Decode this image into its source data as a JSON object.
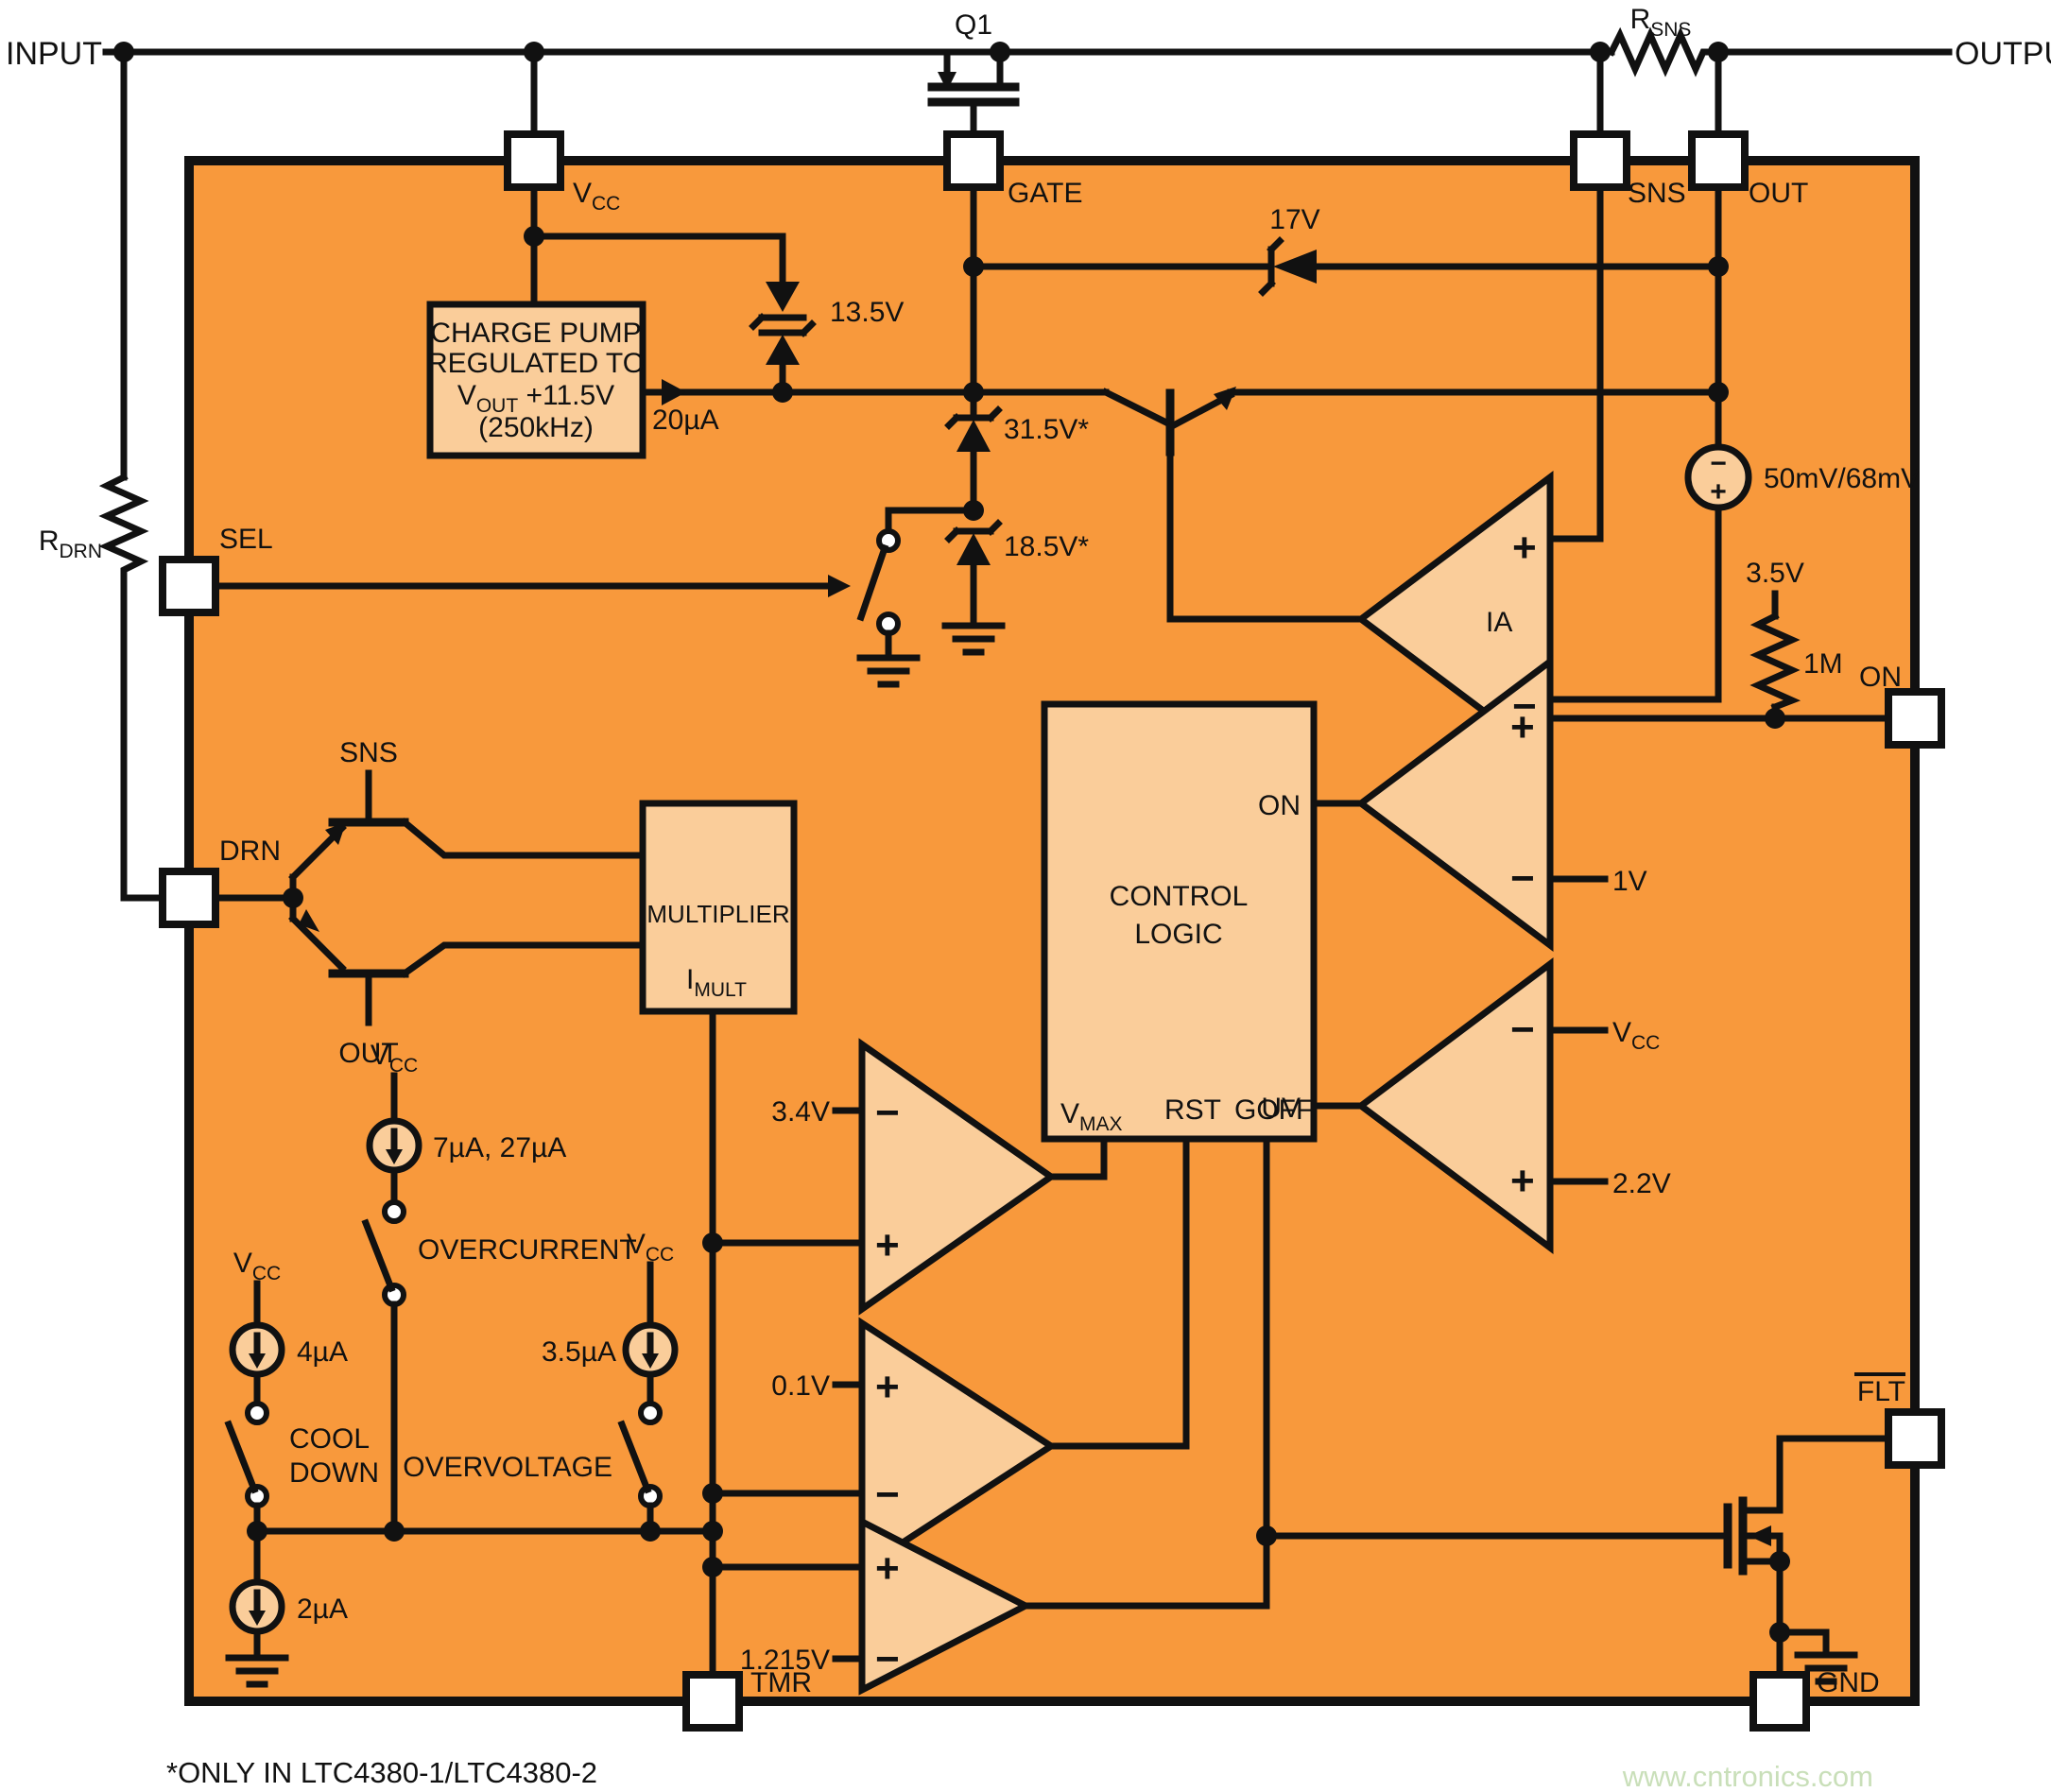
{
  "colors": {
    "ic_fill": "#f8993c",
    "block_fill": "#facd9a",
    "line": "#111111",
    "pin_fill": "#ffffff",
    "watermark": "#c9dfb9"
  },
  "symbols": {
    "plus": "+",
    "minus": "−"
  },
  "external": {
    "input": "INPUT",
    "output": "OUTPUT",
    "q1": "Q1",
    "rsns": {
      "base": "R",
      "sub": "SNS"
    },
    "rdrn": {
      "base": "R",
      "sub": "DRN"
    }
  },
  "pins": {
    "vcc": {
      "base": "V",
      "sub": "CC"
    },
    "gate": "GATE",
    "sns": "SNS",
    "out": "OUT",
    "sel": "SEL",
    "drn": "DRN",
    "on": "ON",
    "flt": "FLT",
    "tmr": "TMR",
    "gnd": "GND"
  },
  "charge_pump": {
    "line1": "CHARGE PUMP",
    "line2": "REGULATED TO",
    "line3_base": "V",
    "line3_sub": "OUT",
    "line3_rest": " +11.5V",
    "line4": "(250kHz)",
    "output_current": "20µA"
  },
  "zeners": {
    "z13v5": "13.5V",
    "z17v": "17V",
    "z31v5": "31.5V*",
    "z18v5": "18.5V*"
  },
  "ia": {
    "label": "IA",
    "offset_source": "50mV/68mV"
  },
  "on_comparator": {
    "pullup_voltage": "3.5V",
    "pullup_resistor": "1M",
    "minus_ref": "1V"
  },
  "uv_comparator": {
    "minus_ref": {
      "base": "V",
      "sub": "CC"
    },
    "plus_ref": "2.2V"
  },
  "control_logic": {
    "line1": "CONTROL",
    "line2": "LOGIC",
    "on_port": "ON",
    "uv_port": "UV",
    "vmax_port": {
      "base": "V",
      "sub": "MAX"
    },
    "rst_port": "RST",
    "goff_port": "GOFF"
  },
  "multiplier": {
    "label": "MULTIPLIER",
    "imult": {
      "base": "I",
      "sub": "MULT"
    },
    "sns_in": "SNS",
    "out_in": "OUT"
  },
  "current_sources": {
    "overcurrent": {
      "supply": {
        "base": "V",
        "sub": "CC"
      },
      "value": "7µA, 27µA",
      "switch_label": "OVERCURRENT"
    },
    "cooldown": {
      "supply": {
        "base": "V",
        "sub": "CC"
      },
      "value": "4µA",
      "switch_label_1": "COOL",
      "switch_label_2": "DOWN"
    },
    "overvoltage": {
      "supply": {
        "base": "V",
        "sub": "CC"
      },
      "value": "3.5µA",
      "switch_label": "OVERVOLTAGE"
    },
    "timer": {
      "value": "2µA"
    }
  },
  "comparators": {
    "vmax_ref": "3.4V",
    "rst_ref": "0.1V",
    "flt_ref": "1.215V"
  },
  "footnote": "*ONLY IN LTC4380-1/LTC4380-2",
  "watermark": "www.cntronics.com"
}
